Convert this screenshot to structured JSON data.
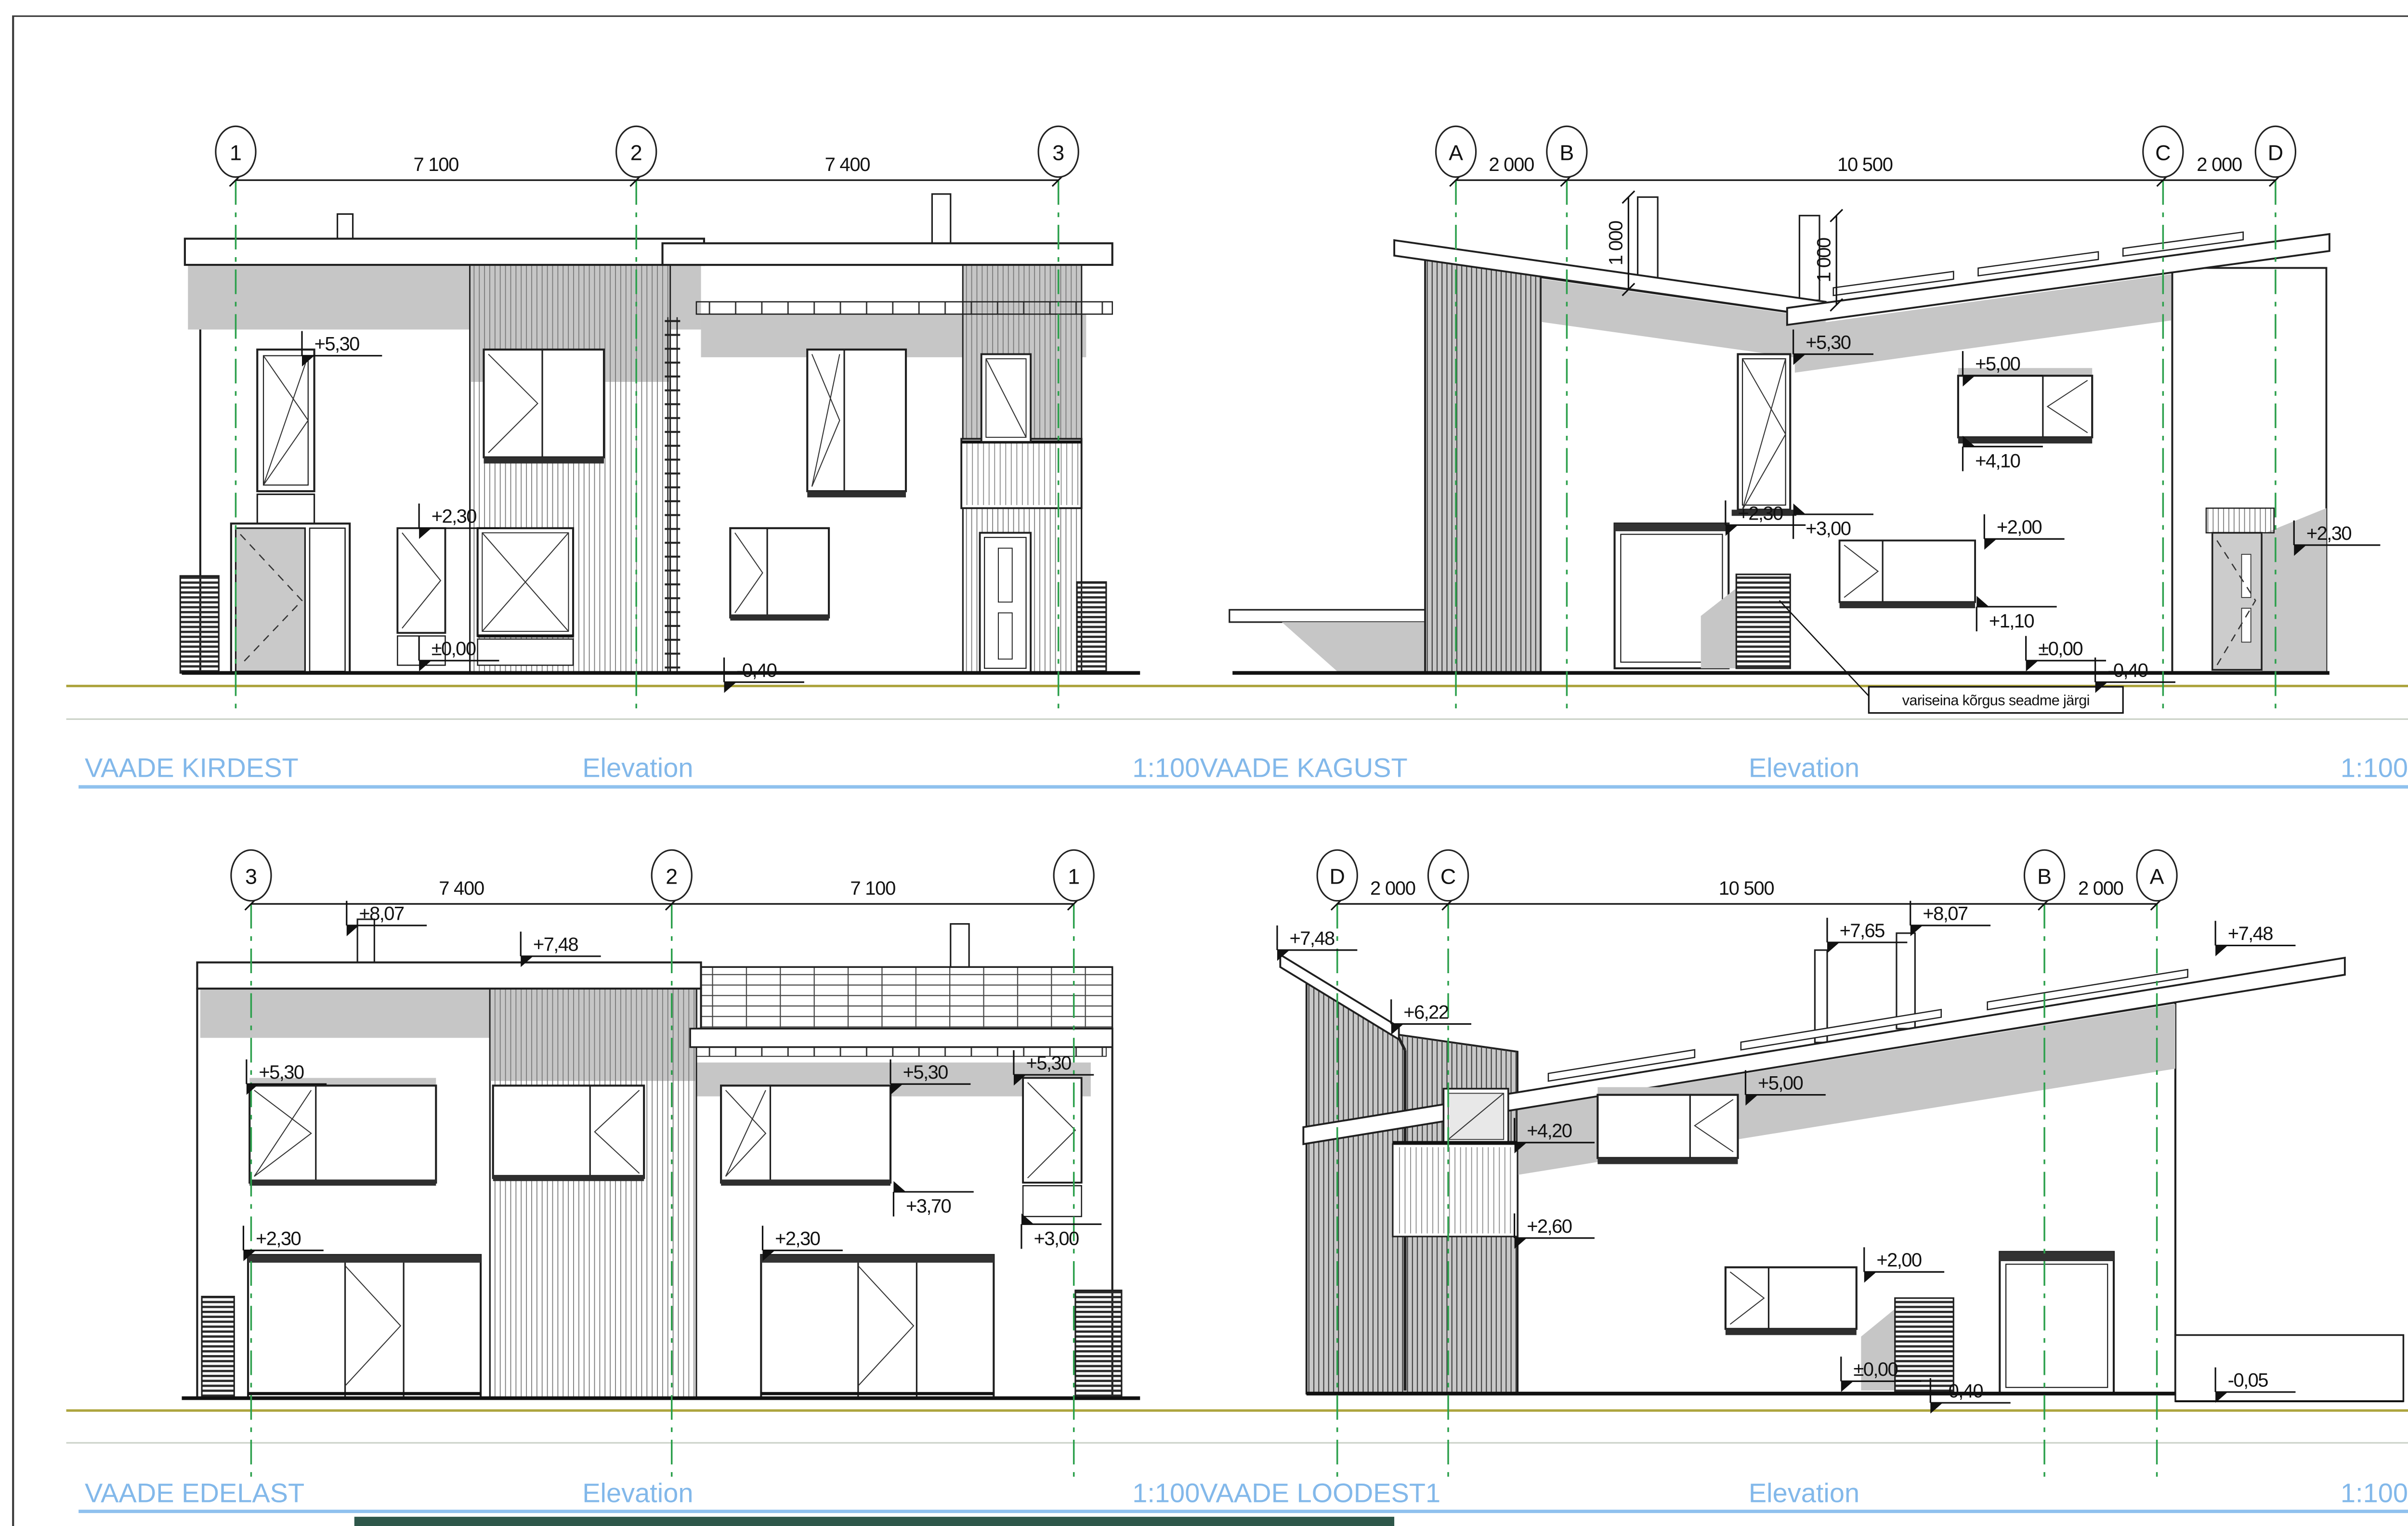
{
  "sheet": {
    "titles": [
      {
        "items": [
          "VAADE KIRDEST",
          "Elevation",
          "1:100VAADE KAGUST",
          "Elevation",
          "1:100"
        ]
      },
      {
        "items": [
          "VAADE EDELAST",
          "Elevation",
          "1:100VAADE LOODEST1",
          "Elevation",
          "1:100"
        ]
      }
    ]
  },
  "d1": {
    "grids": [
      "1",
      "2",
      "3"
    ],
    "dims": [
      "7 100",
      "7 400"
    ],
    "levels": [
      "+5,30",
      "+2,30",
      "±0,00",
      "-0,40"
    ]
  },
  "d2": {
    "grids": [
      "A",
      "B",
      "C",
      "D"
    ],
    "dims": [
      "2 000",
      "10 500",
      "2 000"
    ],
    "levels": [
      "1 000",
      "1 000",
      "+5,30",
      "+5,00",
      "+4,10",
      "+3,00",
      "+2,30",
      "+2,00",
      "+1,10",
      "±0,00",
      "-0,40",
      "+2,30"
    ],
    "note": "variseina kõrgus seadme järgi"
  },
  "d3": {
    "grids": [
      "3",
      "2",
      "1"
    ],
    "dims": [
      "7 400",
      "7 100"
    ],
    "levels": [
      "+8,07",
      "+7,48",
      "+5,30",
      "+5,30",
      "+5,30",
      "+3,70",
      "+3,00",
      "+2,30",
      "+2,30"
    ]
  },
  "d4": {
    "grids": [
      "D",
      "C",
      "B",
      "A"
    ],
    "dims": [
      "2 000",
      "10 500",
      "2 000"
    ],
    "levels": [
      "+7,48",
      "+6,22",
      "+7,65",
      "+8,07",
      "+7,48",
      "+5,00",
      "+4,20",
      "+2,60",
      "+2,00",
      "±0,00",
      "-0,40",
      "-0,05"
    ]
  },
  "colors": {
    "title_blue": "#82b8ea",
    "grid_green": "#2ca04c",
    "terrain_olive": "#ada43e",
    "shadow_gray": "#c6c6c6",
    "footer_green": "#2e574a"
  }
}
